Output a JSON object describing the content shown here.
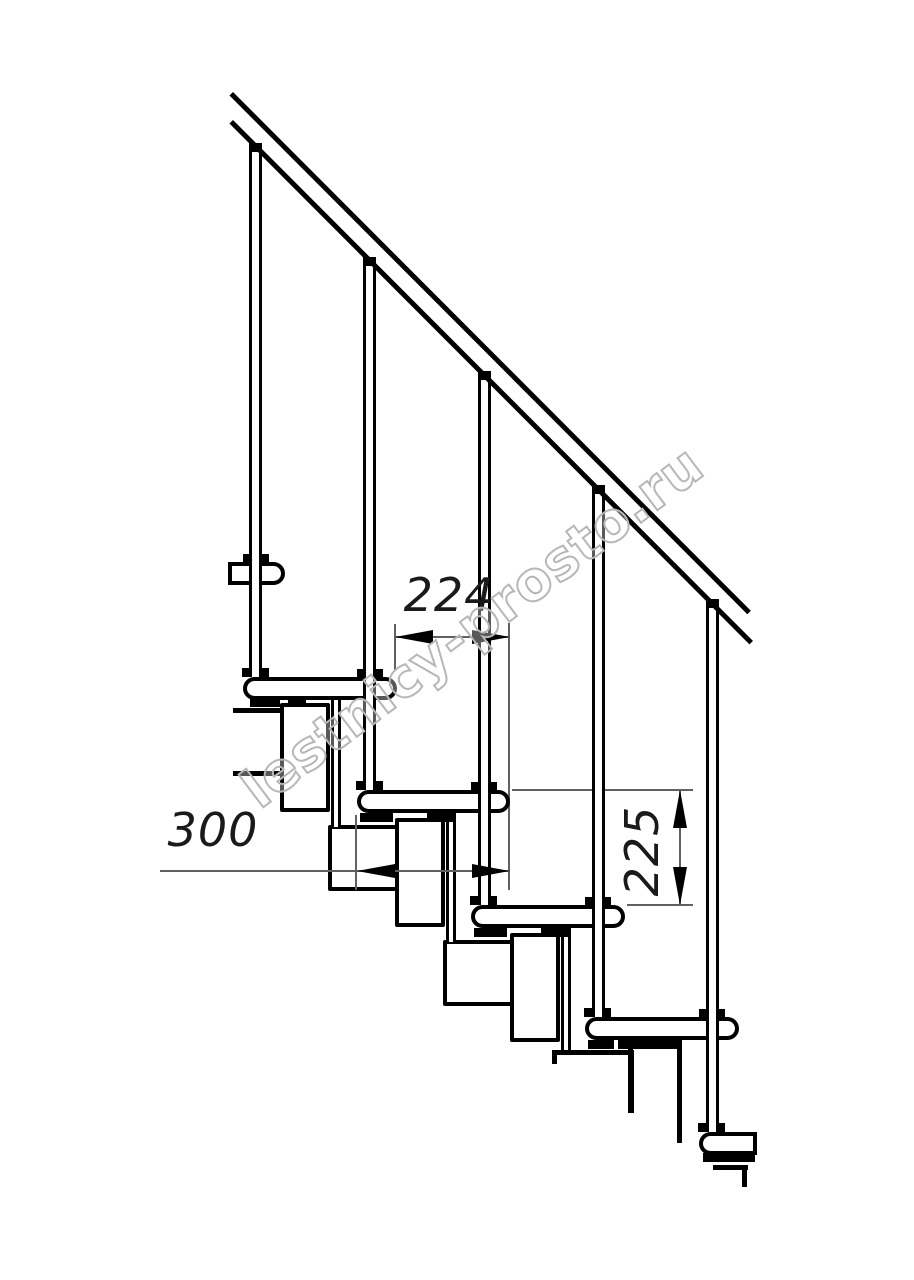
{
  "page": {
    "width": 914,
    "height": 1280,
    "background": "#ffffff",
    "line_color": "#000000",
    "thin_line_color": "#616161"
  },
  "watermark": {
    "text": "lestnicy-prosto.ru",
    "stroke_color": "#b7b7b7",
    "angle_deg": -37
  },
  "dimensions": {
    "step_pitch": {
      "label": "224",
      "orientation": "horizontal"
    },
    "tread_depth": {
      "label": "300",
      "orientation": "horizontal"
    },
    "step_rise": {
      "label": "225",
      "orientation": "vertical"
    }
  },
  "drawing": {
    "shapes": [
      {
        "name": "module-w2-top-line",
        "type": "bar",
        "x": 233,
        "y": 708,
        "w": 55,
        "h": 5
      },
      {
        "name": "module-w2-bottom-line",
        "type": "bar",
        "x": 233,
        "y": 771,
        "w": 55,
        "h": 5
      },
      {
        "name": "module-box-w3",
        "type": "box",
        "x": 328,
        "y": 825,
        "w": 75,
        "h": 66
      },
      {
        "name": "module-box-w4",
        "type": "box",
        "x": 443,
        "y": 940,
        "w": 75,
        "h": 66
      },
      {
        "name": "module-w5-top-line",
        "type": "bar",
        "x": 552,
        "y": 1050,
        "w": 81,
        "h": 5
      },
      {
        "name": "module-w5-left-line",
        "type": "bar",
        "x": 552,
        "y": 1050,
        "w": 5,
        "h": 14
      },
      {
        "name": "module-w5-right-line",
        "type": "bar",
        "x": 629,
        "y": 1050,
        "w": 5,
        "h": 63
      },
      {
        "name": "module-w6-top-line",
        "type": "bar",
        "x": 713,
        "y": 1165,
        "w": 35,
        "h": 5
      },
      {
        "name": "module-w6-right-line",
        "type": "bar",
        "x": 742,
        "y": 1165,
        "w": 5,
        "h": 22
      },
      {
        "name": "module-box-t2",
        "type": "box",
        "x": 280,
        "y": 703,
        "w": 50,
        "h": 109
      },
      {
        "name": "module-box-t3",
        "type": "box",
        "x": 395,
        "y": 818,
        "w": 50,
        "h": 109
      },
      {
        "name": "module-box-t4",
        "type": "box",
        "x": 510,
        "y": 933,
        "w": 50,
        "h": 109
      },
      {
        "name": "module-t5-left-line",
        "type": "bar",
        "x": 628,
        "y": 1048,
        "w": 5,
        "h": 65
      },
      {
        "name": "module-t5-right-line",
        "type": "bar",
        "x": 677,
        "y": 1040,
        "w": 5,
        "h": 103
      },
      {
        "name": "connector-tube-2",
        "type": "post",
        "x": 331,
        "y": 698,
        "w": 10,
        "h": 129
      },
      {
        "name": "connector-tube-3",
        "type": "post",
        "x": 446,
        "y": 813,
        "w": 10,
        "h": 129
      },
      {
        "name": "connector-tube-4",
        "type": "post",
        "x": 561,
        "y": 928,
        "w": 10,
        "h": 122
      },
      {
        "name": "dim-224-ext-left-line",
        "type": "thin",
        "x": 394,
        "y": 624,
        "w": 2,
        "h": 46
      },
      {
        "name": "dim-224-ext-right-line",
        "type": "thin",
        "x": 508,
        "y": 623,
        "w": 2,
        "h": 267
      },
      {
        "name": "dim-224-line",
        "type": "thin",
        "x": 395,
        "y": 636,
        "w": 115,
        "h": 2
      },
      {
        "name": "dim-300-line",
        "type": "thin",
        "x": 160,
        "y": 870,
        "w": 350,
        "h": 2
      },
      {
        "name": "dim-300-ext-left-line",
        "type": "thin",
        "x": 355,
        "y": 815,
        "w": 2,
        "h": 75
      },
      {
        "name": "dim-225-ext-top-line",
        "type": "thin",
        "x": 512,
        "y": 789,
        "w": 181,
        "h": 2
      },
      {
        "name": "dim-225-ext-bottom-line",
        "type": "thin",
        "x": 627,
        "y": 904,
        "w": 66,
        "h": 2
      },
      {
        "name": "dim-225-line",
        "type": "thin",
        "x": 679,
        "y": 790,
        "w": 2,
        "h": 115
      },
      {
        "name": "tread-1",
        "type": "box",
        "x": 228,
        "y": 562,
        "w": 57,
        "h": 23,
        "br": "0 12px 12px 0"
      },
      {
        "name": "tread-2",
        "type": "box",
        "x": 243,
        "y": 677,
        "w": 154,
        "h": 23,
        "br": "12px"
      },
      {
        "name": "tread-3",
        "type": "box",
        "x": 357,
        "y": 790,
        "w": 153,
        "h": 23,
        "br": "12px"
      },
      {
        "name": "tread-4",
        "type": "box",
        "x": 471,
        "y": 905,
        "w": 154,
        "h": 23,
        "br": "12px"
      },
      {
        "name": "tread-5",
        "type": "box",
        "x": 585,
        "y": 1017,
        "w": 154,
        "h": 23,
        "br": "12px"
      },
      {
        "name": "tread-6",
        "type": "box",
        "x": 699,
        "y": 1132,
        "w": 58,
        "h": 23,
        "br": "12px 0 0 12px"
      },
      {
        "name": "tread-2-foot-a",
        "type": "bar",
        "x": 250,
        "y": 698,
        "w": 30,
        "h": 9
      },
      {
        "name": "tread-2-foot-b",
        "type": "bar",
        "x": 288,
        "y": 698,
        "w": 18,
        "h": 9
      },
      {
        "name": "tread-3-foot-a",
        "type": "bar",
        "x": 360,
        "y": 813,
        "w": 33,
        "h": 9
      },
      {
        "name": "tread-3-foot-b",
        "type": "bar",
        "x": 427,
        "y": 813,
        "w": 28,
        "h": 9
      },
      {
        "name": "tread-4-foot-a",
        "type": "bar",
        "x": 474,
        "y": 928,
        "w": 33,
        "h": 9
      },
      {
        "name": "tread-4-foot-b",
        "type": "bar",
        "x": 541,
        "y": 928,
        "w": 28,
        "h": 9
      },
      {
        "name": "tread-5-foot-a",
        "type": "bar",
        "x": 588,
        "y": 1040,
        "w": 26,
        "h": 9
      },
      {
        "name": "tread-5-foot-b",
        "type": "bar",
        "x": 618,
        "y": 1040,
        "w": 59,
        "h": 9
      },
      {
        "name": "tread-6-foot",
        "type": "bar",
        "x": 703,
        "y": 1153,
        "w": 52,
        "h": 9
      },
      {
        "name": "baluster-1-collar",
        "type": "bar",
        "x": 243,
        "y": 554,
        "w": 26,
        "h": 8
      },
      {
        "name": "baluster-2-collar",
        "type": "bar",
        "x": 357,
        "y": 669,
        "w": 26,
        "h": 8
      },
      {
        "name": "baluster-3-collar",
        "type": "bar",
        "x": 471,
        "y": 782,
        "w": 26,
        "h": 8
      },
      {
        "name": "baluster-4-collar",
        "type": "bar",
        "x": 585,
        "y": 897,
        "w": 26,
        "h": 8
      },
      {
        "name": "baluster-5-collar",
        "type": "bar",
        "x": 699,
        "y": 1009,
        "w": 26,
        "h": 8
      },
      {
        "name": "baluster-1-flange",
        "type": "bar",
        "x": 242,
        "y": 668,
        "w": 27,
        "h": 9
      },
      {
        "name": "baluster-2-flange",
        "type": "bar",
        "x": 356,
        "y": 781,
        "w": 27,
        "h": 9
      },
      {
        "name": "baluster-3-flange",
        "type": "bar",
        "x": 470,
        "y": 896,
        "w": 27,
        "h": 9
      },
      {
        "name": "baluster-4-flange",
        "type": "bar",
        "x": 584,
        "y": 1008,
        "w": 27,
        "h": 9
      },
      {
        "name": "baluster-5-flange",
        "type": "bar",
        "x": 698,
        "y": 1123,
        "w": 27,
        "h": 9
      },
      {
        "name": "baluster-1",
        "type": "post",
        "x": 249,
        "y": 152,
        "w": 13,
        "h": 525
      },
      {
        "name": "baluster-2",
        "type": "post",
        "x": 363,
        "y": 266,
        "w": 13,
        "h": 524
      },
      {
        "name": "baluster-3",
        "type": "post",
        "x": 478,
        "y": 380,
        "w": 13,
        "h": 525
      },
      {
        "name": "baluster-4",
        "type": "post",
        "x": 592,
        "y": 494,
        "w": 13,
        "h": 523
      },
      {
        "name": "baluster-5",
        "type": "post",
        "x": 706,
        "y": 608,
        "w": 13,
        "h": 524
      },
      {
        "name": "baluster-1-cap",
        "type": "bar",
        "x": 249,
        "y": 143,
        "w": 13,
        "h": 9
      },
      {
        "name": "baluster-2-cap",
        "type": "bar",
        "x": 363,
        "y": 257,
        "w": 13,
        "h": 9
      },
      {
        "name": "baluster-3-cap",
        "type": "bar",
        "x": 478,
        "y": 371,
        "w": 13,
        "h": 9
      },
      {
        "name": "baluster-4-cap",
        "type": "bar",
        "x": 592,
        "y": 485,
        "w": 13,
        "h": 9
      },
      {
        "name": "baluster-5-cap",
        "type": "bar",
        "x": 706,
        "y": 599,
        "w": 13,
        "h": 9
      },
      {
        "name": "handrail-outer-line",
        "type": "rot",
        "x": 233,
        "y": 92,
        "len": 733,
        "th": 5,
        "angle": 45.05
      },
      {
        "name": "handrail-inner-line",
        "type": "rot",
        "x": 233,
        "y": 120,
        "len": 736,
        "th": 5,
        "angle": 45.05
      },
      {
        "name": "dim-224-arrow-left",
        "type": "tri",
        "dir": "left",
        "x": 395,
        "y": 630
      },
      {
        "name": "dim-224-arrow-right",
        "type": "tri",
        "dir": "right",
        "x": 472,
        "y": 630
      },
      {
        "name": "dim-300-arrow-left",
        "type": "tri",
        "dir": "left",
        "x": 357,
        "y": 864
      },
      {
        "name": "dim-300-arrow-right",
        "type": "tri",
        "dir": "right",
        "x": 472,
        "y": 864
      },
      {
        "name": "dim-225-arrow-up",
        "type": "tri",
        "dir": "up",
        "x": 673,
        "y": 790
      },
      {
        "name": "dim-225-arrow-down",
        "type": "tri",
        "dir": "down",
        "x": 673,
        "y": 867
      }
    ]
  }
}
